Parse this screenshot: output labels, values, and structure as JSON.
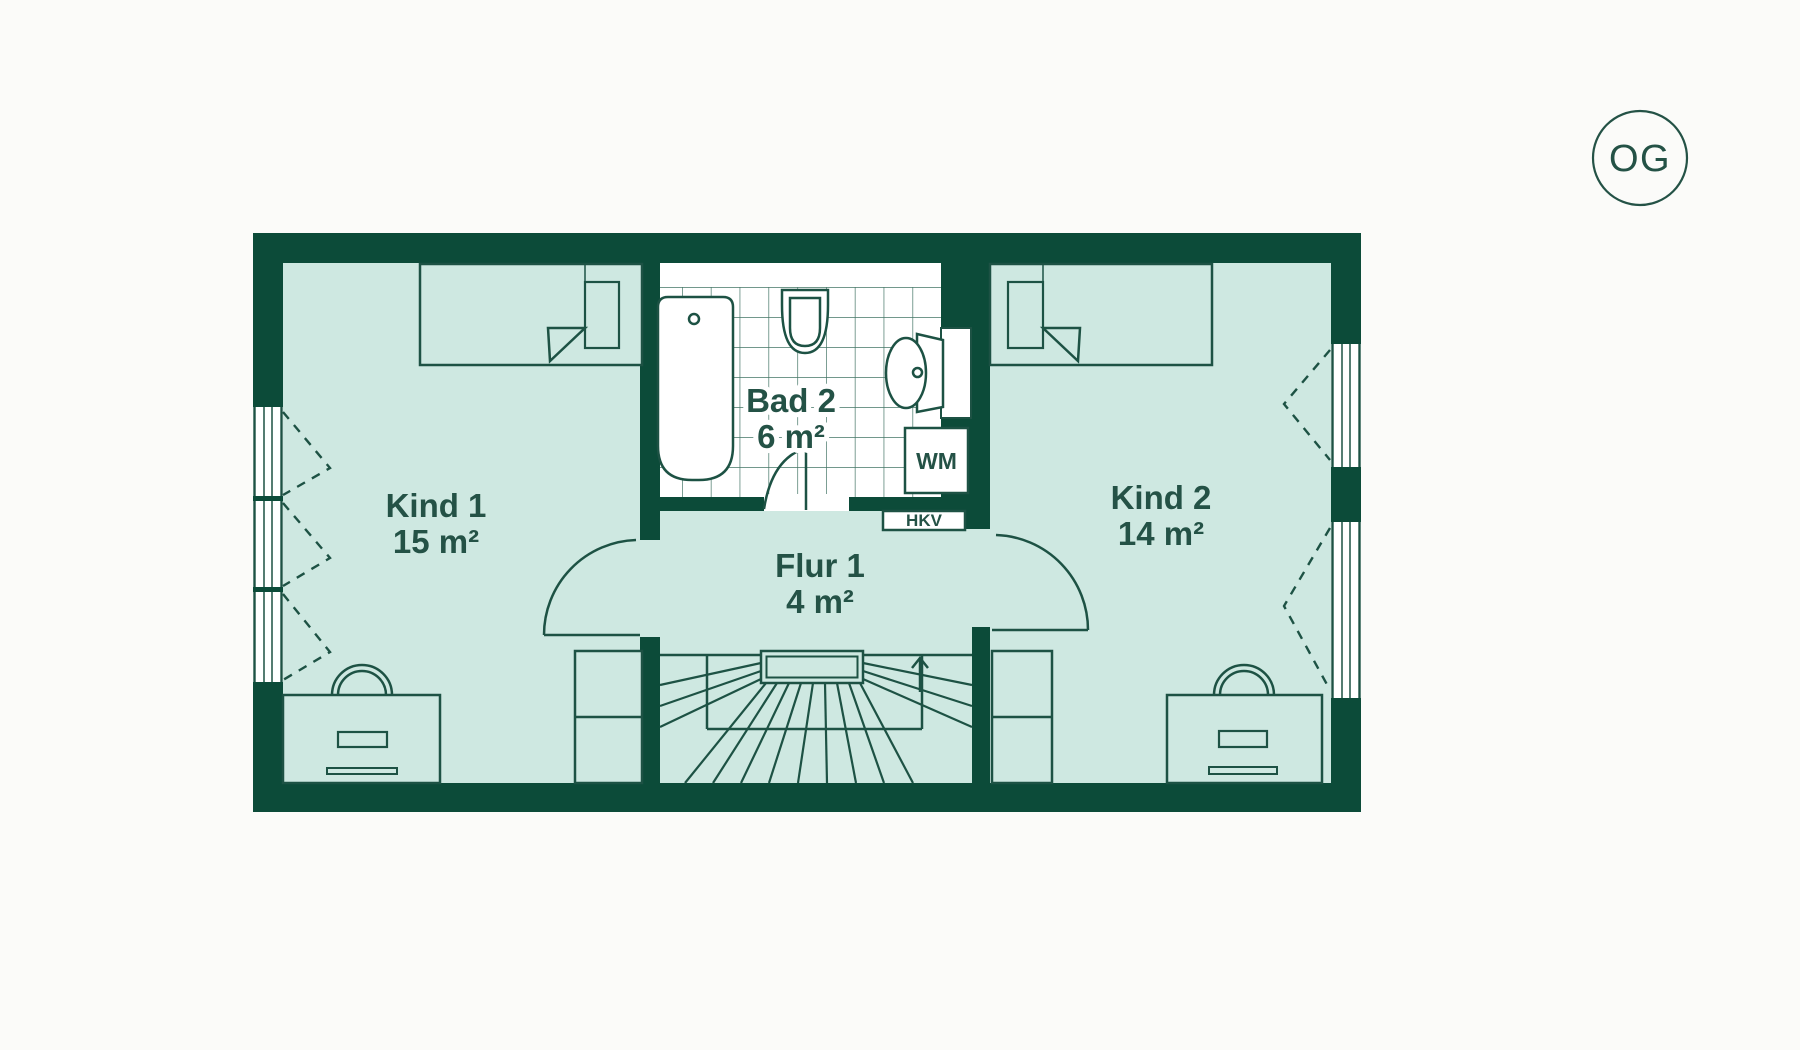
{
  "floor_badge": {
    "label": "OG"
  },
  "rooms": [
    {
      "id": "kind1",
      "name": "Kind 1",
      "area": "15 m²"
    },
    {
      "id": "kind2",
      "name": "Kind 2",
      "area": "14 m²"
    },
    {
      "id": "bad2",
      "name": "Bad 2",
      "area": "6 m²"
    },
    {
      "id": "flur1",
      "name": "Flur 1",
      "area": "4 m²"
    }
  ],
  "labels": {
    "washing_machine": "WM",
    "heating_manifold": "HKV"
  },
  "colors": {
    "wall": "#0c4b39",
    "room_fill": "#cee8e1",
    "bath_white": "#ffffff",
    "line": "#1d5244",
    "tile_line": "#447566",
    "text": "#245246",
    "background": "#fbfbf9"
  }
}
